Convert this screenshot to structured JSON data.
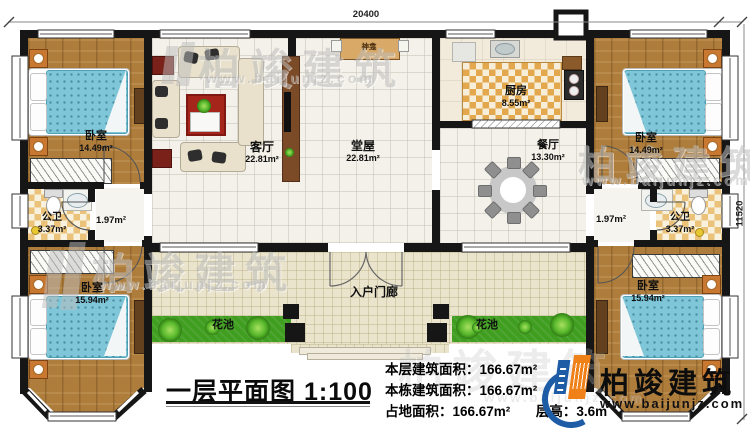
{
  "dimensions": {
    "top": "20400",
    "right": "11520"
  },
  "title_block": {
    "title": "一层平面图",
    "scale": "1:100"
  },
  "stats": {
    "floor_area_label": "本层建筑面积：",
    "floor_area_value": "166.67m²",
    "building_area_label": "本栋建筑面积：",
    "building_area_value": "166.67m²",
    "land_area_label": "占地面积：",
    "land_area_value": "166.67m²",
    "height_label": "层高：",
    "height_value": "3.6m"
  },
  "brand": {
    "name": "柏竣建筑",
    "url": "www.baijunjz.com"
  },
  "watermark": {
    "name": "柏竣建筑",
    "url": "www.baijunjz.com"
  },
  "rooms": {
    "bedroom_tl": {
      "name": "卧室",
      "area": "14.49m²"
    },
    "bedroom_tr": {
      "name": "卧室",
      "area": "14.49m²"
    },
    "bedroom_bl": {
      "name": "卧室",
      "area": "15.94m²"
    },
    "bedroom_br": {
      "name": "卧室",
      "area": "15.94m²"
    },
    "living_room": {
      "name": "客厅",
      "area": "22.81m²"
    },
    "central_hall": {
      "name": "堂屋",
      "area": "22.81m²"
    },
    "kitchen": {
      "name": "厨房",
      "area": "8.55m²"
    },
    "dining_room": {
      "name": "餐厅",
      "area": "13.30m²"
    },
    "bathroom_left": {
      "name": "公卫",
      "area": "3.37m²"
    },
    "bathroom_right": {
      "name": "公卫",
      "area": "3.37m²"
    },
    "vestibule_left": {
      "area": "1.97m²"
    },
    "vestibule_right": {
      "area": "1.97m²"
    },
    "entry_porch": {
      "name": "入户门廊"
    },
    "flower_bed_left": {
      "name": "花池"
    },
    "flower_bed_right": {
      "name": "花池"
    },
    "shrine": {
      "name": "神龛"
    }
  }
}
